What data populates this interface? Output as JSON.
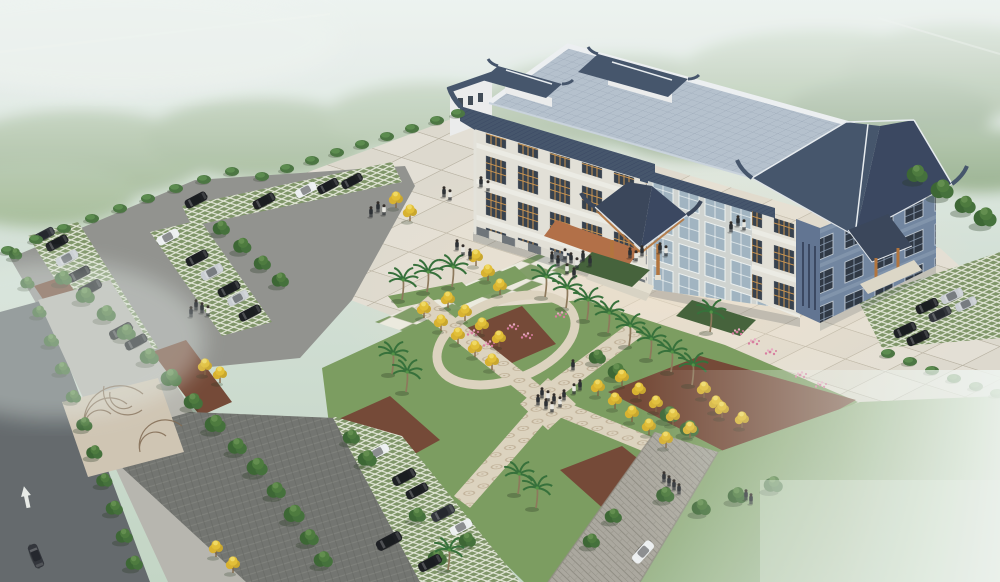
{
  "meta": {
    "description": "Aerial architectural rendering of a Chinese-style civic building with tiled pavilion roofs, entrance canopy, paved plaza, X-shaped garden paths, palm rows, golden trees, parking lots with cars, and misty green surroundings",
    "type": "architectural-aerial-rendering"
  },
  "palette": {
    "mist_top": "#e9efec",
    "forest": "#95ad85",
    "plaza": "#e4dfd4",
    "checker_green": "#7e9a63",
    "lawn": "#7fa05e",
    "garden_lawn": "#78995a",
    "entrance_lawn": "#3f5c33",
    "mulch": "#70422f",
    "mosaic": "#ddd2bd",
    "asphalt": "#8f8f8b",
    "asphalt_dark": "#6e6f6b",
    "street": "#5f6467",
    "sidewalk": "#b6b4ac",
    "stone_road": "#a9a59b",
    "roof_light": "#b4bfcc",
    "roof_dark": "#3f4e66",
    "roof_darker": "#33405a",
    "wall_white": "#eceded",
    "wall_cream": "#e3e0d6",
    "facade_blue": "#6d819c",
    "facade_blue_dark": "#5c6f8e",
    "window_orange": "#c99049",
    "wood_orange": "#b06f35",
    "canopy_dark": "#333f54",
    "terracotta": "#b06a40",
    "car_black": "#15161a",
    "car_dark": "#2b2d33",
    "car_silver": "#c9ccd1",
    "car_white": "#eef0f1",
    "people_dark": "#23262b",
    "people_white": "#e8e6e0",
    "tree_green": "#3e6b33",
    "palm_green": "#2f6b32",
    "yellow_tree": "#e3bd2f",
    "flower_pink": "#d8799c"
  },
  "scene": {
    "building": {
      "style": "chinese-traditional",
      "roof_pavilions": 2,
      "wings": 3,
      "entrance_canopies": 2
    },
    "ground": [
      "plaza",
      "checkerboard-band",
      "garden-with-x-paths",
      "left-parking",
      "bottom-parking",
      "right-parking",
      "street",
      "stone-road",
      "lawn"
    ]
  },
  "vegetation": {
    "trees": [
      [
        150,
        362,
        1
      ],
      [
        172,
        384,
        1.1
      ],
      [
        194,
        407,
        1
      ],
      [
        216,
        430,
        1.1
      ],
      [
        238,
        452,
        1
      ],
      [
        258,
        473,
        1.1
      ],
      [
        277,
        496,
        1
      ],
      [
        295,
        520,
        1.1
      ],
      [
        310,
        543,
        1
      ],
      [
        324,
        565,
        1
      ],
      [
        64,
        283,
        0.9
      ],
      [
        86,
        301,
        1
      ],
      [
        107,
        319,
        1
      ],
      [
        127,
        338,
        1
      ],
      [
        222,
        233,
        0.9
      ],
      [
        243,
        251,
        0.95
      ],
      [
        263,
        268,
        0.9
      ],
      [
        281,
        285,
        0.9
      ],
      [
        16,
        258,
        0.7
      ],
      [
        28,
        287,
        0.75
      ],
      [
        40,
        316,
        0.75
      ],
      [
        52,
        345,
        0.8
      ],
      [
        63,
        373,
        0.8
      ],
      [
        74,
        401,
        0.8
      ],
      [
        85,
        429,
        0.85
      ],
      [
        95,
        457,
        0.85
      ],
      [
        105,
        485,
        0.85
      ],
      [
        115,
        513,
        0.9
      ],
      [
        125,
        541,
        0.9
      ],
      [
        135,
        568,
        0.9
      ],
      [
        918,
        180,
        1.1
      ],
      [
        943,
        196,
        1.2
      ],
      [
        966,
        211,
        1.1
      ],
      [
        986,
        224,
        1.2
      ],
      [
        598,
        362,
        0.9
      ],
      [
        618,
        377,
        1
      ],
      [
        670,
        420,
        1
      ],
      [
        690,
        434,
        1
      ],
      [
        352,
        442,
        0.9
      ],
      [
        368,
        464,
        1
      ],
      [
        438,
        563,
        1
      ],
      [
        468,
        545,
        0.9
      ],
      [
        418,
        520,
        0.9
      ],
      [
        592,
        546,
        0.9
      ],
      [
        614,
        521,
        0.9
      ],
      [
        666,
        500,
        0.95
      ],
      [
        702,
        513,
        1
      ],
      [
        738,
        501,
        1
      ],
      [
        774,
        490,
        1
      ]
    ],
    "bushes": [
      [
        8,
        252
      ],
      [
        36,
        241
      ],
      [
        64,
        230
      ],
      [
        92,
        220
      ],
      [
        120,
        210
      ],
      [
        148,
        200
      ],
      [
        176,
        190
      ],
      [
        204,
        181
      ],
      [
        232,
        173
      ],
      [
        262,
        178
      ],
      [
        287,
        170
      ],
      [
        312,
        162
      ],
      [
        337,
        154
      ],
      [
        362,
        146
      ],
      [
        387,
        138
      ],
      [
        412,
        130
      ],
      [
        437,
        122
      ],
      [
        458,
        115
      ],
      [
        888,
        355
      ],
      [
        910,
        363
      ],
      [
        932,
        372
      ],
      [
        954,
        380
      ],
      [
        976,
        388
      ],
      [
        997,
        395
      ]
    ],
    "palms": [
      [
        402,
        300
      ],
      [
        427,
        292
      ],
      [
        452,
        287
      ],
      [
        545,
        297
      ],
      [
        566,
        308
      ],
      [
        587,
        320
      ],
      [
        608,
        333
      ],
      [
        629,
        346
      ],
      [
        650,
        359
      ],
      [
        671,
        372
      ],
      [
        692,
        385
      ],
      [
        710,
        332
      ],
      [
        392,
        374
      ],
      [
        406,
        392
      ],
      [
        448,
        570
      ],
      [
        518,
        494
      ],
      [
        536,
        508
      ]
    ],
    "yellow_trees": [
      [
        424,
        318
      ],
      [
        441,
        331
      ],
      [
        458,
        344
      ],
      [
        475,
        357
      ],
      [
        492,
        370
      ],
      [
        448,
        308
      ],
      [
        465,
        321
      ],
      [
        482,
        334
      ],
      [
        499,
        347
      ],
      [
        598,
        396
      ],
      [
        615,
        409
      ],
      [
        632,
        422
      ],
      [
        649,
        435
      ],
      [
        666,
        448
      ],
      [
        622,
        386
      ],
      [
        639,
        399
      ],
      [
        656,
        412
      ],
      [
        673,
        425
      ],
      [
        690,
        438
      ],
      [
        476,
        266
      ],
      [
        488,
        281
      ],
      [
        500,
        295
      ],
      [
        396,
        208
      ],
      [
        410,
        221
      ],
      [
        205,
        375
      ],
      [
        220,
        383
      ],
      [
        216,
        557
      ],
      [
        233,
        573
      ],
      [
        704,
        398
      ],
      [
        722,
        418
      ],
      [
        742,
        428
      ],
      [
        716,
        412
      ]
    ],
    "flowers": [
      [
        512,
        327
      ],
      [
        526,
        336
      ],
      [
        488,
        344
      ],
      [
        472,
        333
      ],
      [
        737,
        332
      ],
      [
        753,
        342
      ],
      [
        770,
        352
      ],
      [
        800,
        375
      ],
      [
        820,
        385
      ],
      [
        560,
        315
      ]
    ]
  },
  "vehicles": {
    "cars": [
      [
        44,
        235,
        -28,
        "car_dark",
        0.95
      ],
      [
        57,
        243,
        -28,
        "car_black",
        1
      ],
      [
        67,
        258,
        -28,
        "car_silver",
        1
      ],
      [
        79,
        274,
        -28,
        "car_black",
        1
      ],
      [
        90,
        288,
        -28,
        "car_black",
        1.05
      ],
      [
        121,
        331,
        -28,
        "car_black",
        1.05
      ],
      [
        136,
        342,
        -28,
        "car_black",
        1
      ],
      [
        168,
        237,
        -28,
        "car_white",
        1
      ],
      [
        197,
        258,
        -28,
        "car_black",
        1
      ],
      [
        212,
        272,
        -28,
        "car_silver",
        1
      ],
      [
        229,
        289,
        -28,
        "car_black",
        1
      ],
      [
        238,
        298,
        -28,
        "car_silver",
        0.95
      ],
      [
        250,
        313,
        -28,
        "car_black",
        1
      ],
      [
        196,
        200,
        -28,
        "car_black",
        1
      ],
      [
        264,
        201,
        -28,
        "car_black",
        1
      ],
      [
        306,
        190,
        -28,
        "car_white",
        0.95
      ],
      [
        328,
        186,
        -28,
        "car_black",
        0.95
      ],
      [
        352,
        181,
        -28,
        "car_black",
        0.95
      ],
      [
        378,
        452,
        -28,
        "car_white",
        1
      ],
      [
        404,
        477,
        -28,
        "car_black",
        1.05
      ],
      [
        417,
        491,
        -28,
        "car_black",
        1
      ],
      [
        443,
        513,
        -28,
        "car_dark",
        1.05
      ],
      [
        461,
        527,
        -28,
        "car_white",
        1
      ],
      [
        389,
        541,
        -28,
        "car_black",
        1.15
      ],
      [
        430,
        563,
        -28,
        "car_black",
        1.05
      ],
      [
        952,
        296,
        -25,
        "car_silver",
        1
      ],
      [
        966,
        304,
        -25,
        "car_silver",
        0.95
      ],
      [
        927,
        306,
        -25,
        "car_black",
        1
      ],
      [
        940,
        314,
        -25,
        "car_dark",
        1
      ],
      [
        905,
        330,
        -25,
        "car_black",
        1
      ],
      [
        918,
        338,
        -25,
        "car_black",
        1
      ],
      [
        36,
        556,
        68,
        "car_dark",
        1.05
      ],
      [
        643,
        552,
        132,
        "car_white",
        1.1
      ]
    ]
  },
  "people": [
    [
      552,
      262,
      "d"
    ],
    [
      558,
      266,
      "d"
    ],
    [
      565,
      259,
      "w"
    ],
    [
      571,
      263,
      "d"
    ],
    [
      577,
      268,
      "w"
    ],
    [
      583,
      261,
      "d"
    ],
    [
      590,
      266,
      "d"
    ],
    [
      567,
      274,
      "w"
    ],
    [
      574,
      278,
      "d"
    ],
    [
      630,
      258,
      "d"
    ],
    [
      636,
      261,
      "w"
    ],
    [
      642,
      256,
      "d"
    ],
    [
      660,
      253,
      "d"
    ],
    [
      666,
      256,
      "w"
    ],
    [
      378,
      212,
      "d"
    ],
    [
      384,
      215,
      "w"
    ],
    [
      371,
      217,
      "d"
    ],
    [
      444,
      197,
      "d"
    ],
    [
      450,
      200,
      "w"
    ],
    [
      457,
      250,
      "d"
    ],
    [
      463,
      255,
      "w"
    ],
    [
      470,
      259,
      "d"
    ],
    [
      481,
      187,
      "d"
    ],
    [
      488,
      191,
      "w"
    ],
    [
      738,
      226,
      "d"
    ],
    [
      744,
      230,
      "w"
    ],
    [
      731,
      232,
      "d"
    ],
    [
      542,
      398,
      "d"
    ],
    [
      548,
      401,
      "w"
    ],
    [
      554,
      404,
      "d"
    ],
    [
      560,
      407,
      "w"
    ],
    [
      546,
      409,
      "d"
    ],
    [
      552,
      412,
      "w"
    ],
    [
      538,
      405,
      "d"
    ],
    [
      564,
      400,
      "d"
    ],
    [
      574,
      394,
      "w"
    ],
    [
      580,
      390,
      "d"
    ],
    [
      664,
      482,
      "d"
    ],
    [
      669,
      486,
      "d"
    ],
    [
      674,
      490,
      "d"
    ],
    [
      679,
      494,
      "d"
    ],
    [
      746,
      500,
      "d"
    ],
    [
      751,
      504,
      "d"
    ],
    [
      196,
      310,
      "d"
    ],
    [
      202,
      313,
      "d"
    ],
    [
      208,
      316,
      "w"
    ],
    [
      191,
      317,
      "d"
    ],
    [
      573,
      370,
      "d"
    ]
  ]
}
